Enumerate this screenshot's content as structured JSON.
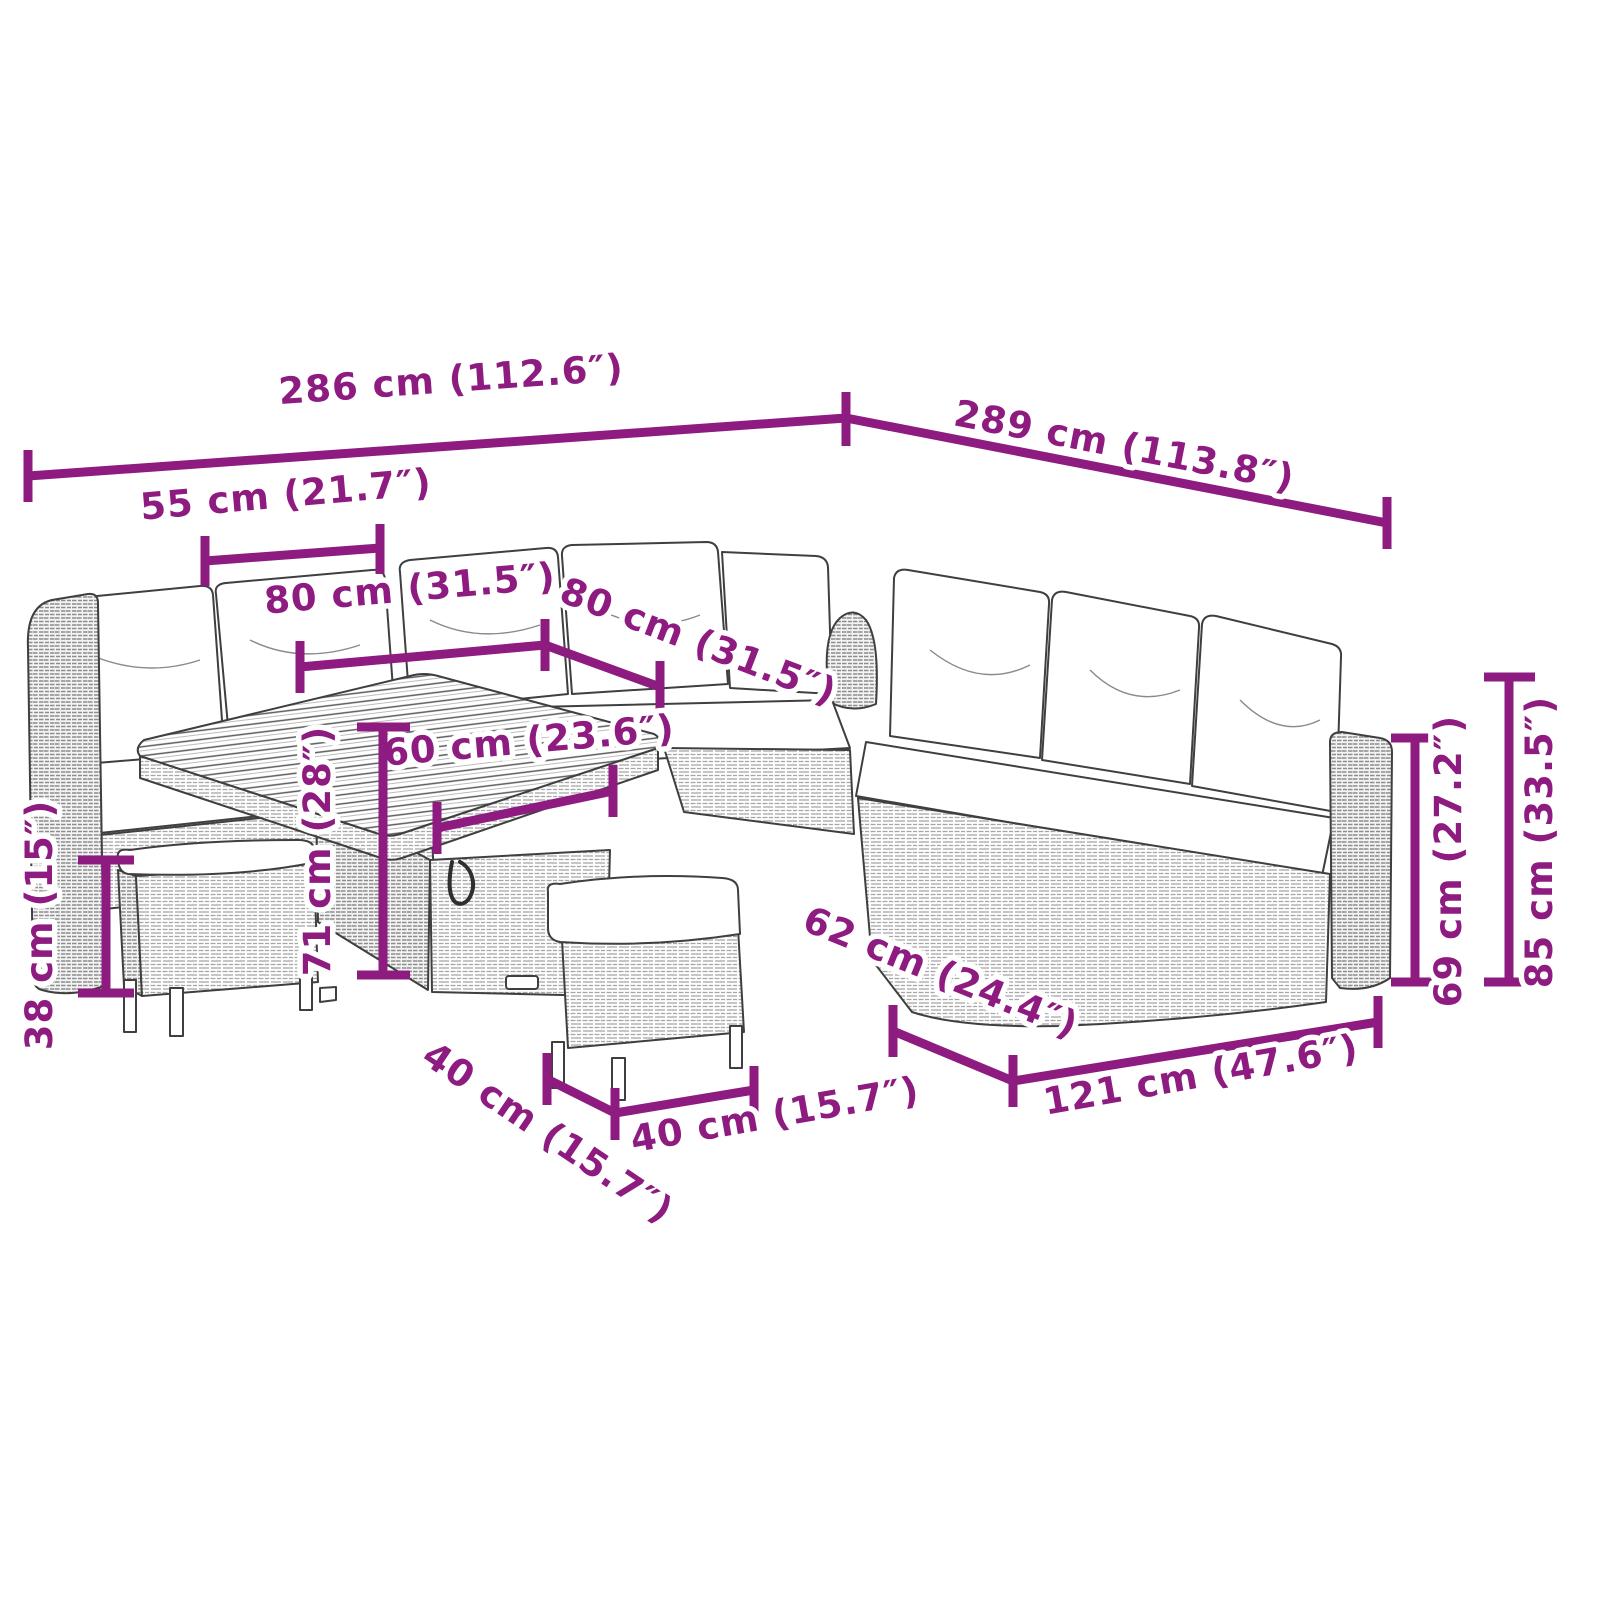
{
  "diagram": {
    "type": "product-dimension-diagram",
    "subject": "poly-rattan garden lounge set with cushions, storage table and two stools",
    "unit_primary": "cm",
    "unit_secondary": "inch"
  },
  "colors": {
    "dimension_accent": "#8e1b80",
    "line_art": "#3f3f3f",
    "cushion_fill": "#ffffff",
    "background": "#ffffff"
  },
  "dims": [
    {
      "id": "back-width-left",
      "label": "286 cm (112.6″)"
    },
    {
      "id": "back-width-right",
      "label": "289 cm (113.8″)"
    },
    {
      "id": "seat-width",
      "label": "55 cm (21.7″)"
    },
    {
      "id": "table-top-width",
      "label": "80 cm (31.5″)"
    },
    {
      "id": "table-top-depth",
      "label": "80 cm (31.5″)"
    },
    {
      "id": "table-base-width",
      "label": "60 cm (23.6″)"
    },
    {
      "id": "table-height",
      "label": "71 cm (28″)"
    },
    {
      "id": "stool-height",
      "label": "38 cm (15″)"
    },
    {
      "id": "stool-depth",
      "label": "40 cm (15.7″)"
    },
    {
      "id": "stool-width",
      "label": "40 cm (15.7″)"
    },
    {
      "id": "sofa-depth",
      "label": "62 cm (24.4″)"
    },
    {
      "id": "sofa-section-width",
      "label": "121 cm (47.6″)"
    },
    {
      "id": "armrest-height",
      "label": "69 cm (27.2″)"
    },
    {
      "id": "backrest-height",
      "label": "85 cm (33.5″)"
    }
  ]
}
